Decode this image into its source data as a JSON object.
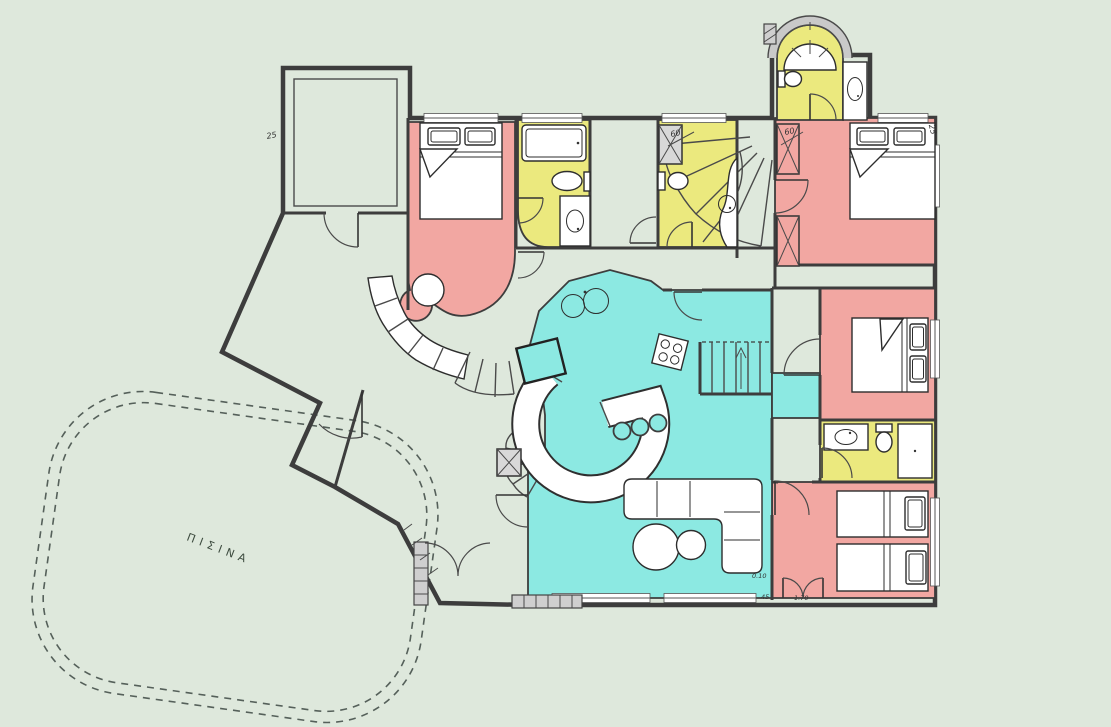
{
  "pool": {
    "label": "ΠΙΣΙΝΑ"
  },
  "dimensions": [
    "25",
    "25",
    "60",
    "60",
    "0.10",
    "45",
    "1.70"
  ],
  "colors": {
    "background": "#dee8dc",
    "floor": "#d3d3d3",
    "bedroom": "#f2a7a2",
    "bathroom": "#ebe97e",
    "living": "#8ce9e2",
    "closet_gray": "#d8d8d8",
    "wall": "#3d3d3d",
    "white": "#ffffff"
  }
}
